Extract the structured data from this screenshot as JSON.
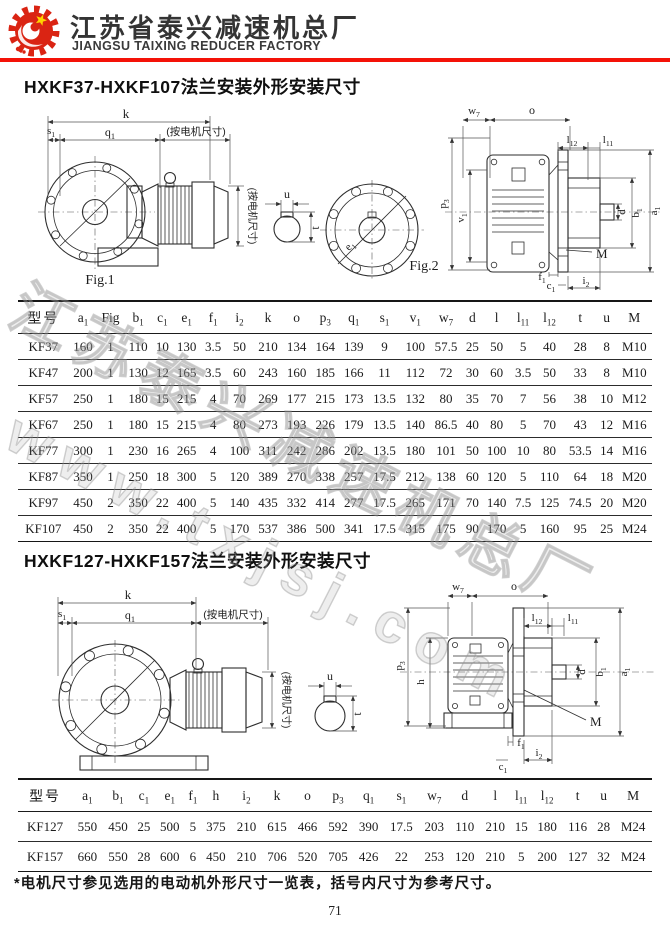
{
  "header": {
    "factory_name_cn": "江苏省泰兴减速机总厂",
    "factory_name_en": "JIANGSU TAIXING REDUCER FACTORY",
    "rule_color": "#f41208",
    "logo_red": "#da2413",
    "logo_yellow": "#ffd400"
  },
  "watermark": {
    "line1": "江苏泰兴减速机总厂",
    "line2": "www.txjsj.com"
  },
  "section1": {
    "title": "HXKF37-HXKF107法兰安装外形安装尺寸",
    "fig1_caption": "Fig.1",
    "fig2_caption": "Fig.2",
    "motor_dim_h": "(按电机尺寸)",
    "motor_dim_v": "(按电机尺寸)",
    "labels": {
      "k": "k",
      "s1": {
        "t": "s",
        "sub": "1"
      },
      "q1": {
        "t": "q",
        "sub": "1"
      },
      "u": "u",
      "t": "t",
      "e1": {
        "t": "e",
        "sub": "1"
      },
      "w7": {
        "t": "w",
        "sub": "7"
      },
      "o": "o",
      "l12": {
        "t": "l",
        "sub": "12"
      },
      "l11": {
        "t": "l",
        "sub": "11"
      },
      "p3": {
        "t": "p",
        "sub": "3"
      },
      "v1": {
        "t": "v",
        "sub": "1"
      },
      "d": "d",
      "b1": {
        "t": "b",
        "sub": "1"
      },
      "a1": {
        "t": "a",
        "sub": "1"
      },
      "M": "M",
      "f1": {
        "t": "f",
        "sub": "1"
      },
      "c1": {
        "t": "c",
        "sub": "1"
      },
      "i2": {
        "t": "i",
        "sub": "2"
      }
    }
  },
  "table1": {
    "headers": [
      "型号",
      {
        "t": "a",
        "sub": "1"
      },
      "Fig",
      {
        "t": "b",
        "sub": "1"
      },
      {
        "t": "c",
        "sub": "1"
      },
      {
        "t": "e",
        "sub": "1"
      },
      {
        "t": "f",
        "sub": "1"
      },
      {
        "t": "i",
        "sub": "2"
      },
      "k",
      "o",
      {
        "t": "p",
        "sub": "3"
      },
      {
        "t": "q",
        "sub": "1"
      },
      {
        "t": "s",
        "sub": "1"
      },
      {
        "t": "v",
        "sub": "1"
      },
      {
        "t": "w",
        "sub": "7"
      },
      "d",
      "l",
      {
        "t": "l",
        "sub": "11"
      },
      {
        "t": "l",
        "sub": "12"
      },
      "t",
      "u",
      "M"
    ],
    "rows": [
      [
        "KF37",
        "160",
        "1",
        "110",
        "10",
        "130",
        "3.5",
        "50",
        "210",
        "134",
        "164",
        "139",
        "9",
        "100",
        "57.5",
        "25",
        "50",
        "5",
        "40",
        "28",
        "8",
        "M10"
      ],
      [
        "KF47",
        "200",
        "1",
        "130",
        "12",
        "165",
        "3.5",
        "60",
        "243",
        "160",
        "185",
        "166",
        "11",
        "112",
        "72",
        "30",
        "60",
        "3.5",
        "50",
        "33",
        "8",
        "M10"
      ],
      [
        "KF57",
        "250",
        "1",
        "180",
        "15",
        "215",
        "4",
        "70",
        "269",
        "177",
        "215",
        "173",
        "13.5",
        "132",
        "80",
        "35",
        "70",
        "7",
        "56",
        "38",
        "10",
        "M12"
      ],
      [
        "KF67",
        "250",
        "1",
        "180",
        "15",
        "215",
        "4",
        "80",
        "273",
        "193",
        "226",
        "179",
        "13.5",
        "140",
        "86.5",
        "40",
        "80",
        "5",
        "70",
        "43",
        "12",
        "M16"
      ],
      [
        "KF77",
        "300",
        "1",
        "230",
        "16",
        "265",
        "4",
        "100",
        "311",
        "242",
        "286",
        "202",
        "13.5",
        "180",
        "101",
        "50",
        "100",
        "10",
        "80",
        "53.5",
        "14",
        "M16"
      ],
      [
        "KF87",
        "350",
        "1",
        "250",
        "18",
        "300",
        "5",
        "120",
        "389",
        "270",
        "338",
        "257",
        "17.5",
        "212",
        "138",
        "60",
        "120",
        "5",
        "110",
        "64",
        "18",
        "M20"
      ],
      [
        "KF97",
        "450",
        "2",
        "350",
        "22",
        "400",
        "5",
        "140",
        "435",
        "332",
        "414",
        "277",
        "17.5",
        "265",
        "171",
        "70",
        "140",
        "7.5",
        "125",
        "74.5",
        "20",
        "M20"
      ],
      [
        "KF107",
        "450",
        "2",
        "350",
        "22",
        "400",
        "5",
        "170",
        "537",
        "386",
        "500",
        "341",
        "17.5",
        "315",
        "175",
        "90",
        "170",
        "5",
        "160",
        "95",
        "25",
        "M24"
      ]
    ]
  },
  "section2": {
    "title": "HXKF127-HXKF157法兰安装外形安装尺寸",
    "motor_dim_h": "(按电机尺寸)",
    "motor_dim_v": "(按电机尺寸)",
    "labels": {
      "k": "k",
      "s1": {
        "t": "s",
        "sub": "1"
      },
      "q1": {
        "t": "q",
        "sub": "1"
      },
      "u": "u",
      "t": "t",
      "w7": {
        "t": "w",
        "sub": "7"
      },
      "o": "o",
      "l12": {
        "t": "l",
        "sub": "12"
      },
      "l11": {
        "t": "l",
        "sub": "11"
      },
      "p3": {
        "t": "p",
        "sub": "3"
      },
      "h": "h",
      "d": "d",
      "b1": {
        "t": "b",
        "sub": "1"
      },
      "a1": {
        "t": "a",
        "sub": "1"
      },
      "M": "M",
      "f1": {
        "t": "f",
        "sub": "1"
      },
      "c1": {
        "t": "c",
        "sub": "1"
      },
      "i2": {
        "t": "i",
        "sub": "2"
      }
    }
  },
  "table2": {
    "headers": [
      "型号",
      {
        "t": "a",
        "sub": "1"
      },
      {
        "t": "b",
        "sub": "1"
      },
      {
        "t": "c",
        "sub": "1"
      },
      {
        "t": "e",
        "sub": "1"
      },
      {
        "t": "f",
        "sub": "1"
      },
      "h",
      {
        "t": "i",
        "sub": "2"
      },
      "k",
      "o",
      {
        "t": "p",
        "sub": "3"
      },
      {
        "t": "q",
        "sub": "1"
      },
      {
        "t": "s",
        "sub": "1"
      },
      {
        "t": "w",
        "sub": "7"
      },
      "d",
      "l",
      {
        "t": "l",
        "sub": "11"
      },
      {
        "t": "l",
        "sub": "12"
      },
      "t",
      "u",
      "M"
    ],
    "rows": [
      [
        "KF127",
        "550",
        "450",
        "25",
        "500",
        "5",
        "375",
        "210",
        "615",
        "466",
        "592",
        "390",
        "17.5",
        "203",
        "110",
        "210",
        "15",
        "180",
        "116",
        "28",
        "M24"
      ],
      [
        "KF157",
        "660",
        "550",
        "28",
        "600",
        "6",
        "450",
        "210",
        "706",
        "520",
        "705",
        "426",
        "22",
        "253",
        "120",
        "210",
        "5",
        "200",
        "127",
        "32",
        "M24"
      ]
    ]
  },
  "footnote": "*电机尺寸参见选用的电动机外形尺寸一览表，括号内尺寸为参考尺寸。",
  "page_number": "71"
}
